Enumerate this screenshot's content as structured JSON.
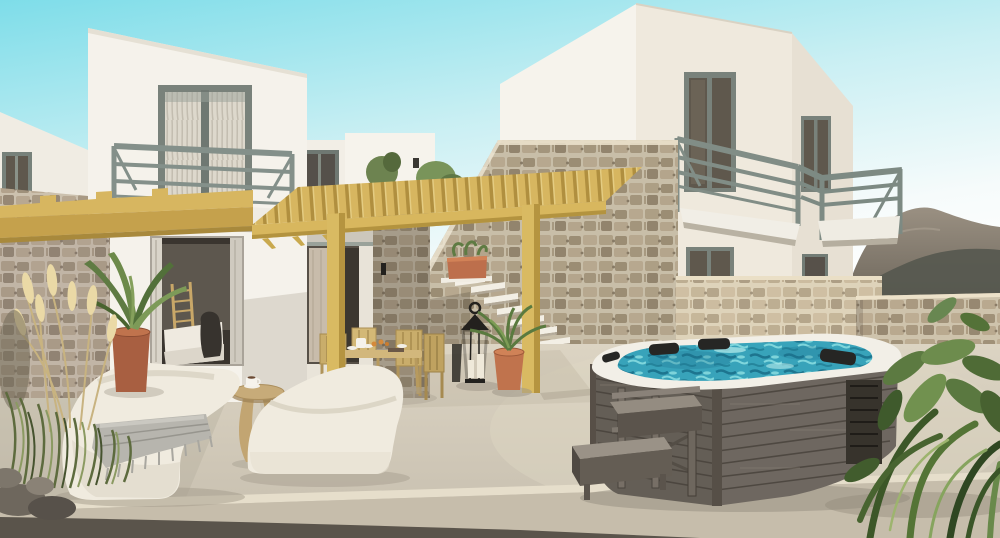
{
  "scene": {
    "type": "3d-architectural-rendering",
    "alt": "Sunlit courtyard of whitewashed two-storey villas with grey-green framed windows and balconies, rustic stone walls, a timber pergola over an outdoor dining set, floating white stairs on a stone wall, two cream lounge chairs with a grey fringed throw, a round wooden side table with a coffee cup, a dark wood-clad hot tub with turquoise water, black headrests and a wooden step stool, terracotta planters, pampas grass, tropical plants and a hazy mountain on the right horizon."
  },
  "palette": {
    "page-bg": "#ffffff",
    "sky-top": "#7edde9",
    "sky-mid": "#c9eff3",
    "sky-low": "#f6fbfb",
    "mountain-top": "#968c7e",
    "mountain-base": "#55584f",
    "wall-bright": "#f6f3ec",
    "wall-front": "#efe9dd",
    "wall-shade": "#e7e0d3",
    "frame-grey": "#79827b",
    "railing-grey": "#818d86",
    "glass-dark": "#5f584d",
    "curtain-cream": "#ddd8cc",
    "stone-mortar": "#d8cdb6",
    "stone-a": "#b9a98d",
    "stone-b": "#a3947a",
    "stone-c": "#c4b499",
    "stone-d": "#998a72",
    "pergola-wood": "#d7b660",
    "pergola-shade": "#b08f3f",
    "tub-wood": "#645e56",
    "tub-wood-light": "#6e6760",
    "tub-rim": "#f2efe7",
    "water-base": "#38a3ba",
    "water-deep": "#1d758f",
    "water-light": "#8fe0e2",
    "headrest-black": "#262624",
    "floor-light": "#d7cfbe",
    "floor-mid": "#c9c1b1",
    "floor-band": "#c6bdab",
    "floor-dark-strip": "#5a544b",
    "lounge-cream": "#f0ebdf",
    "lounge-shade": "#e0dacb",
    "throw-grey": "#b7b5ae",
    "table-wood": "#c7ab79",
    "terracotta": "#c0734d",
    "terracotta-dark": "#a85f41",
    "plant-green": "#5f7b43",
    "plant-green-dark": "#3c5728",
    "plant-green-light": "#86a45e",
    "pampas-cream": "#ead9a6",
    "lantern-black": "#23211e",
    "interior-dark": "#3a352f",
    "bed-white": "#efeae0"
  }
}
